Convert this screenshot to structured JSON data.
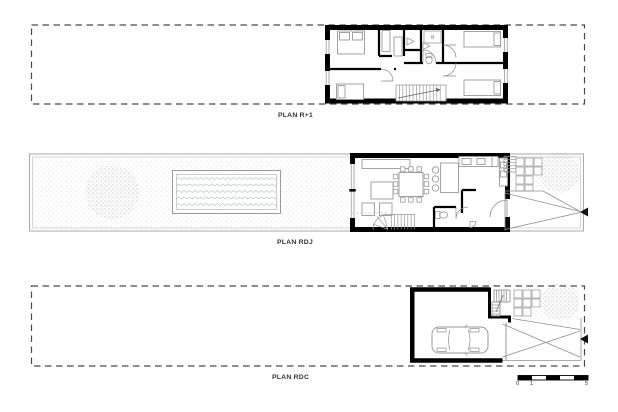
{
  "sheet": {
    "background": "#ffffff"
  },
  "plans": [
    {
      "id": "r1",
      "label": "PLAN R+1"
    },
    {
      "id": "rdj",
      "label": "PLAN RDJ"
    },
    {
      "id": "rdc",
      "label": "PLAN RDC"
    }
  ],
  "scale_bar": {
    "ticks": [
      "0",
      "1",
      "5"
    ]
  },
  "icons": {
    "entrance_arrow_glyph": "◀"
  },
  "colors": {
    "walls": "#000000",
    "furniture_lines": "#9a9a9a",
    "boundary_dashed": "#4a4a4a",
    "site_border": "#a8a8a8",
    "texture_dots": "#d6d6d6",
    "tree_dots": "#bcbcbc",
    "water_lines": "#b4bcc4",
    "label_text": "#333333"
  }
}
